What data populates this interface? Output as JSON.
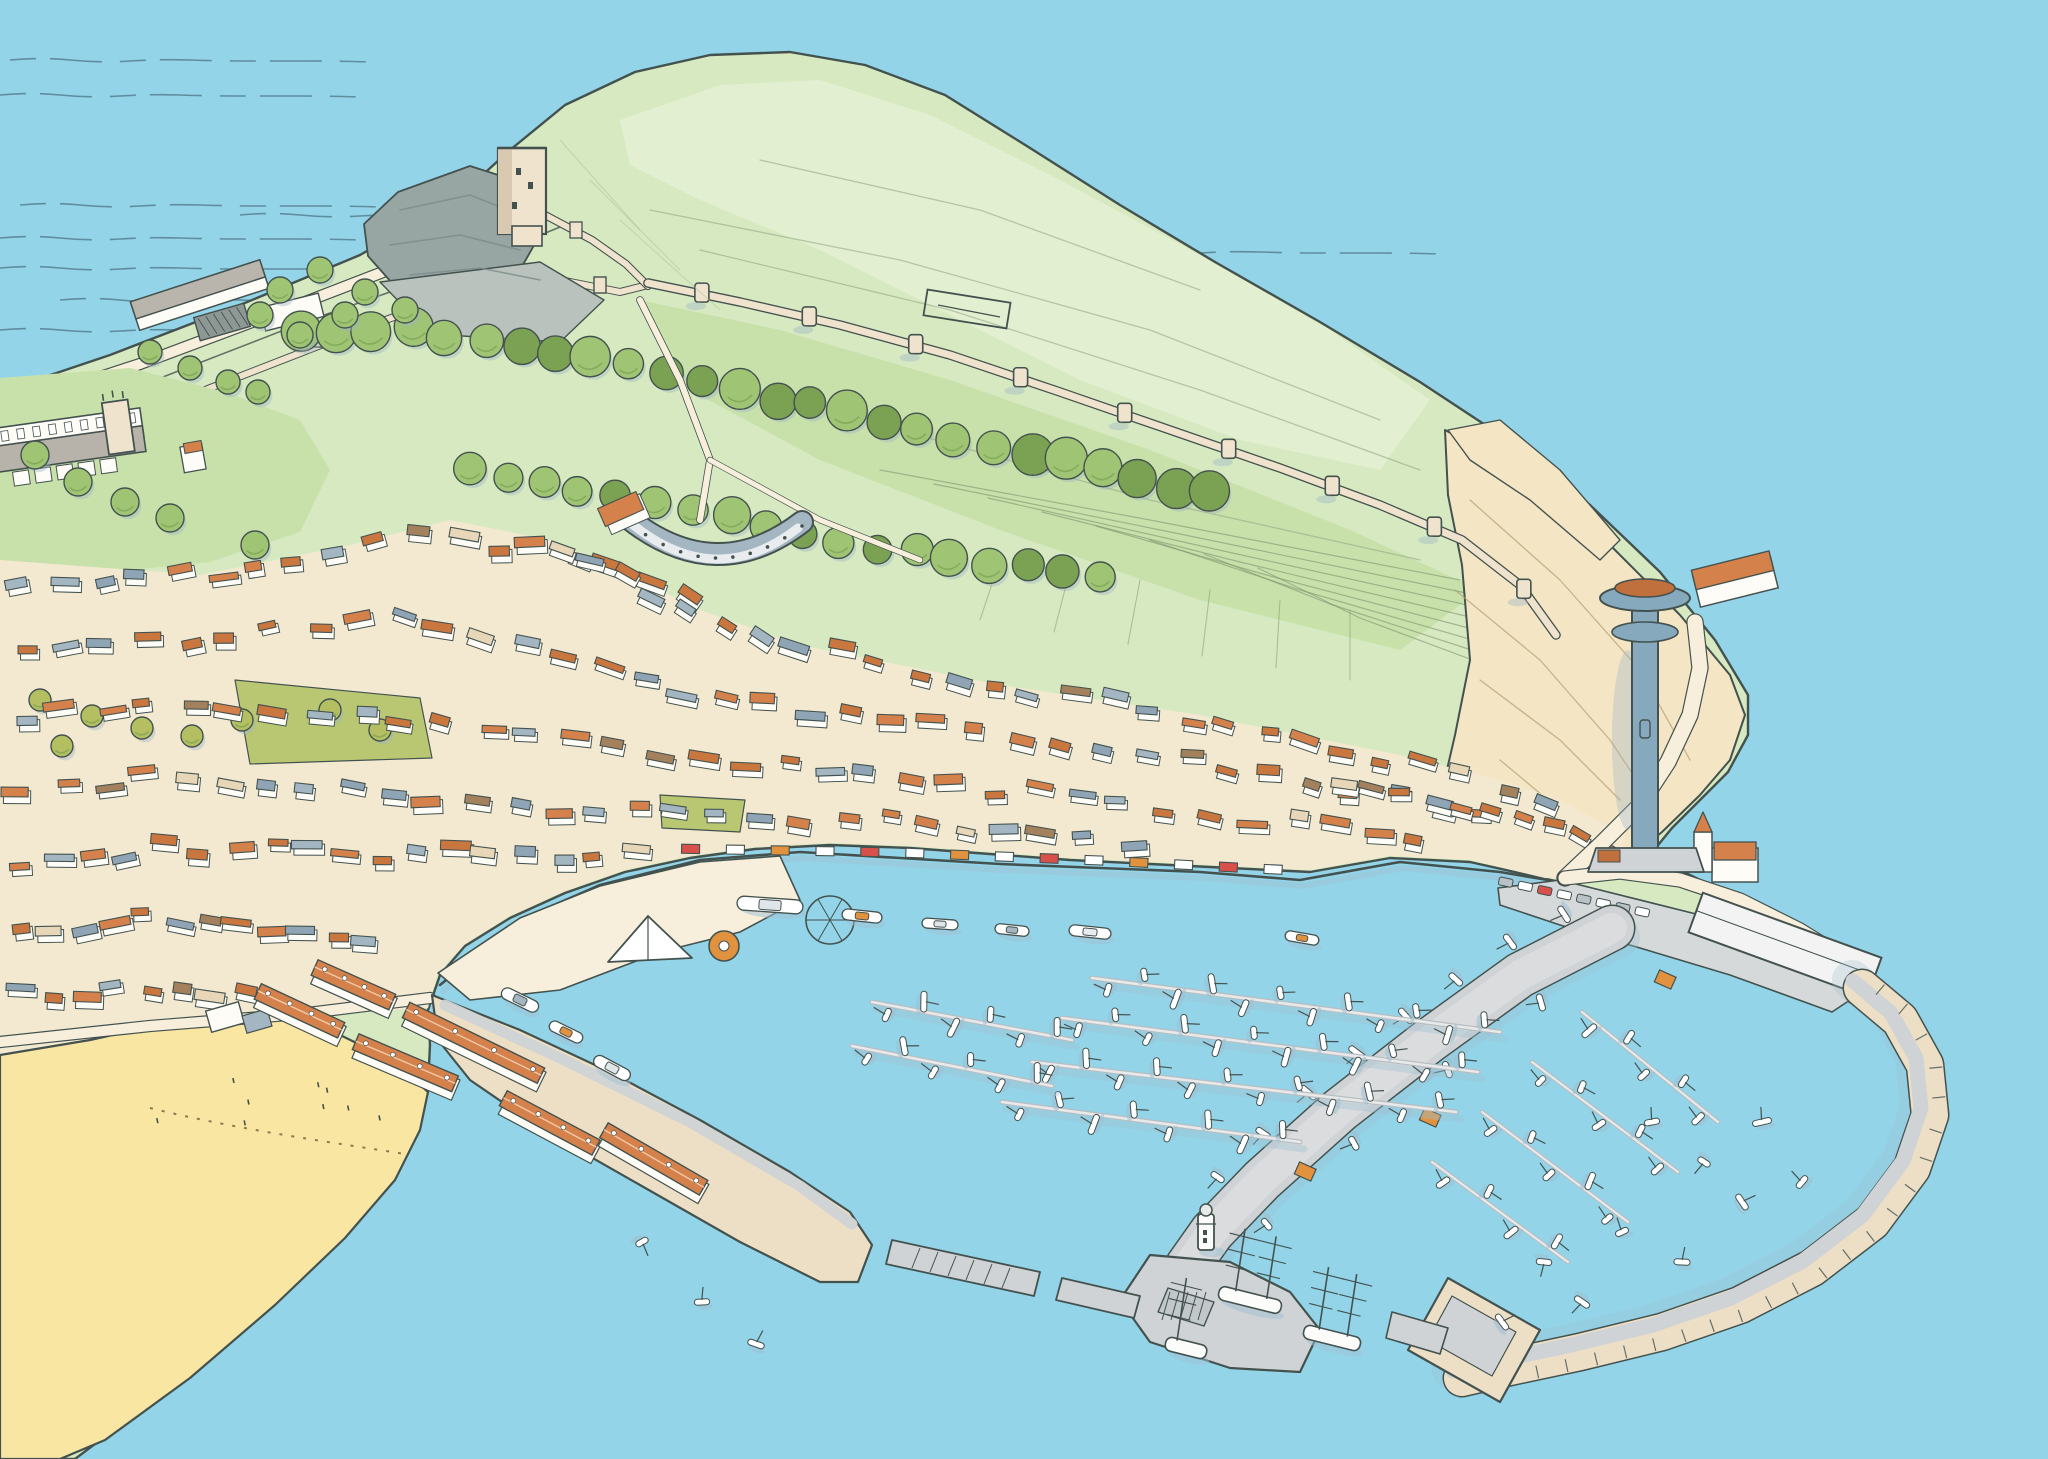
{
  "scene": {
    "description": "Hand-drawn watercolour aerial illustration of a coastal town: grassy castle headland with keep, curtain wall and tree avenue, old town of orange roofs, sandy beach, foreshore amusements, and a working harbour with West Pier sheds, lighthouse pier, tall ships, yacht marina and curved stone East breakwater",
    "palette": {
      "sea": "#93d4e8",
      "ink": "#44524f",
      "waveLine": "#4e7587",
      "grassBase": "#d6e9c0",
      "grassPale": "#e3efd1",
      "grassMid": "#c8e1ab",
      "treeGreen": "#9fc474",
      "treeDark": "#7ba153",
      "treeOlive": "#b4bf62",
      "treeShadow": "#9db4c6",
      "cliffSand": "#f4e5c4",
      "rockGrey": "#97a5a3",
      "rockDark": "#7c8c8b",
      "beachSand": "#f8e6a2",
      "tideDot": "#8b7a4d",
      "roadCream": "#f7efdb",
      "stoneCream": "#efe3cd",
      "stoneShade": "#d8c9b0",
      "townGround": "#f3e9d1",
      "wallWhite": "#fdfcf6",
      "wallShade": "#cfd8dc",
      "roofOrange": "#d4814b",
      "roofOrange2": "#c9763f",
      "roofGrey": "#a3b6c2",
      "roofGrey2": "#8fa5b5",
      "roofBrown": "#a3815c",
      "roofCream": "#e7d7b8",
      "pierGrey": "#cfd3d5",
      "pierWalk": "#e7e9ea",
      "pierSand": "#ecdfc5",
      "boatWhite": "#ffffff",
      "boatShadow": "#9fc0d2",
      "awningRed": "#d8504a",
      "awningOrange": "#e0923f",
      "towerBlue": "#87a9bd",
      "discOrange": "#c0703c",
      "gardenOlive": "#b9c773"
    },
    "features": [
      {
        "name": "sea"
      },
      {
        "name": "castle-headland"
      },
      {
        "name": "castle-keep"
      },
      {
        "name": "curtain-wall"
      },
      {
        "name": "tree-avenue"
      },
      {
        "name": "hilltop-ruin"
      },
      {
        "name": "church"
      },
      {
        "name": "old-town"
      },
      {
        "name": "crescent-terrace"
      },
      {
        "name": "foreshore-amusements"
      },
      {
        "name": "beach"
      },
      {
        "name": "west-pier"
      },
      {
        "name": "pier-sheds"
      },
      {
        "name": "lighthouse-pier"
      },
      {
        "name": "lighthouse"
      },
      {
        "name": "harbour-entrance"
      },
      {
        "name": "marina"
      },
      {
        "name": "tall-ships"
      },
      {
        "name": "east-breakwater"
      },
      {
        "name": "cliff-tower"
      },
      {
        "name": "marine-drive"
      },
      {
        "name": "sandside-quay"
      }
    ],
    "counts": {
      "street_houses": [
        40,
        36,
        34,
        28,
        18,
        12,
        9,
        10,
        5
      ],
      "avenue_trees_upper": 26,
      "avenue_trees_lower": 18,
      "wall_towers": 9,
      "marina_row_boats": [
        12,
        12,
        12,
        8,
        6,
        6
      ],
      "east_row_boats": [
        5,
        5,
        5,
        4
      ],
      "scattered_boats": 13,
      "tall_ships": 3,
      "awnings": 14,
      "parked_cars": 8,
      "pier_sheds": 6
    }
  }
}
